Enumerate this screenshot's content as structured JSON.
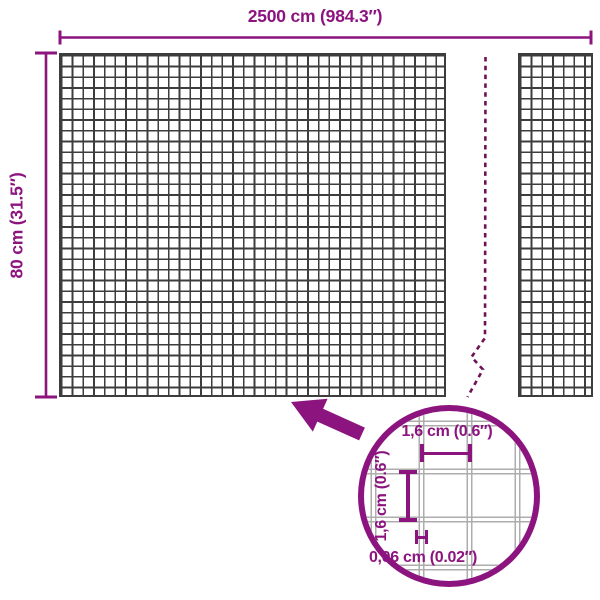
{
  "diagram": {
    "type": "product-dimension-diagram",
    "subject": "wire mesh panel",
    "background": "#ffffff"
  },
  "colors": {
    "accent_purple": "#8C147F",
    "break_line_purple": "#6E1254",
    "mesh_line_gray": "#3D3D3D",
    "magnified_wire_gray": "#ADADAD"
  },
  "mesh": {
    "width_label": "2500 cm (984.3″)",
    "height_label": "80 cm (31.5″)"
  },
  "detail_view": {
    "mesh_opening_width_label": "1,6 cm (0.6″)",
    "mesh_opening_height_label": "1,6 cm (0.6″)",
    "wire_thickness_label": "0,06 cm (0.02″)"
  },
  "icons": {
    "zoom_callout_arrow": "arrow-pointing-up-left",
    "break_line": "dashed-zigzag-break",
    "detail_circle": "magnifier-circle"
  }
}
